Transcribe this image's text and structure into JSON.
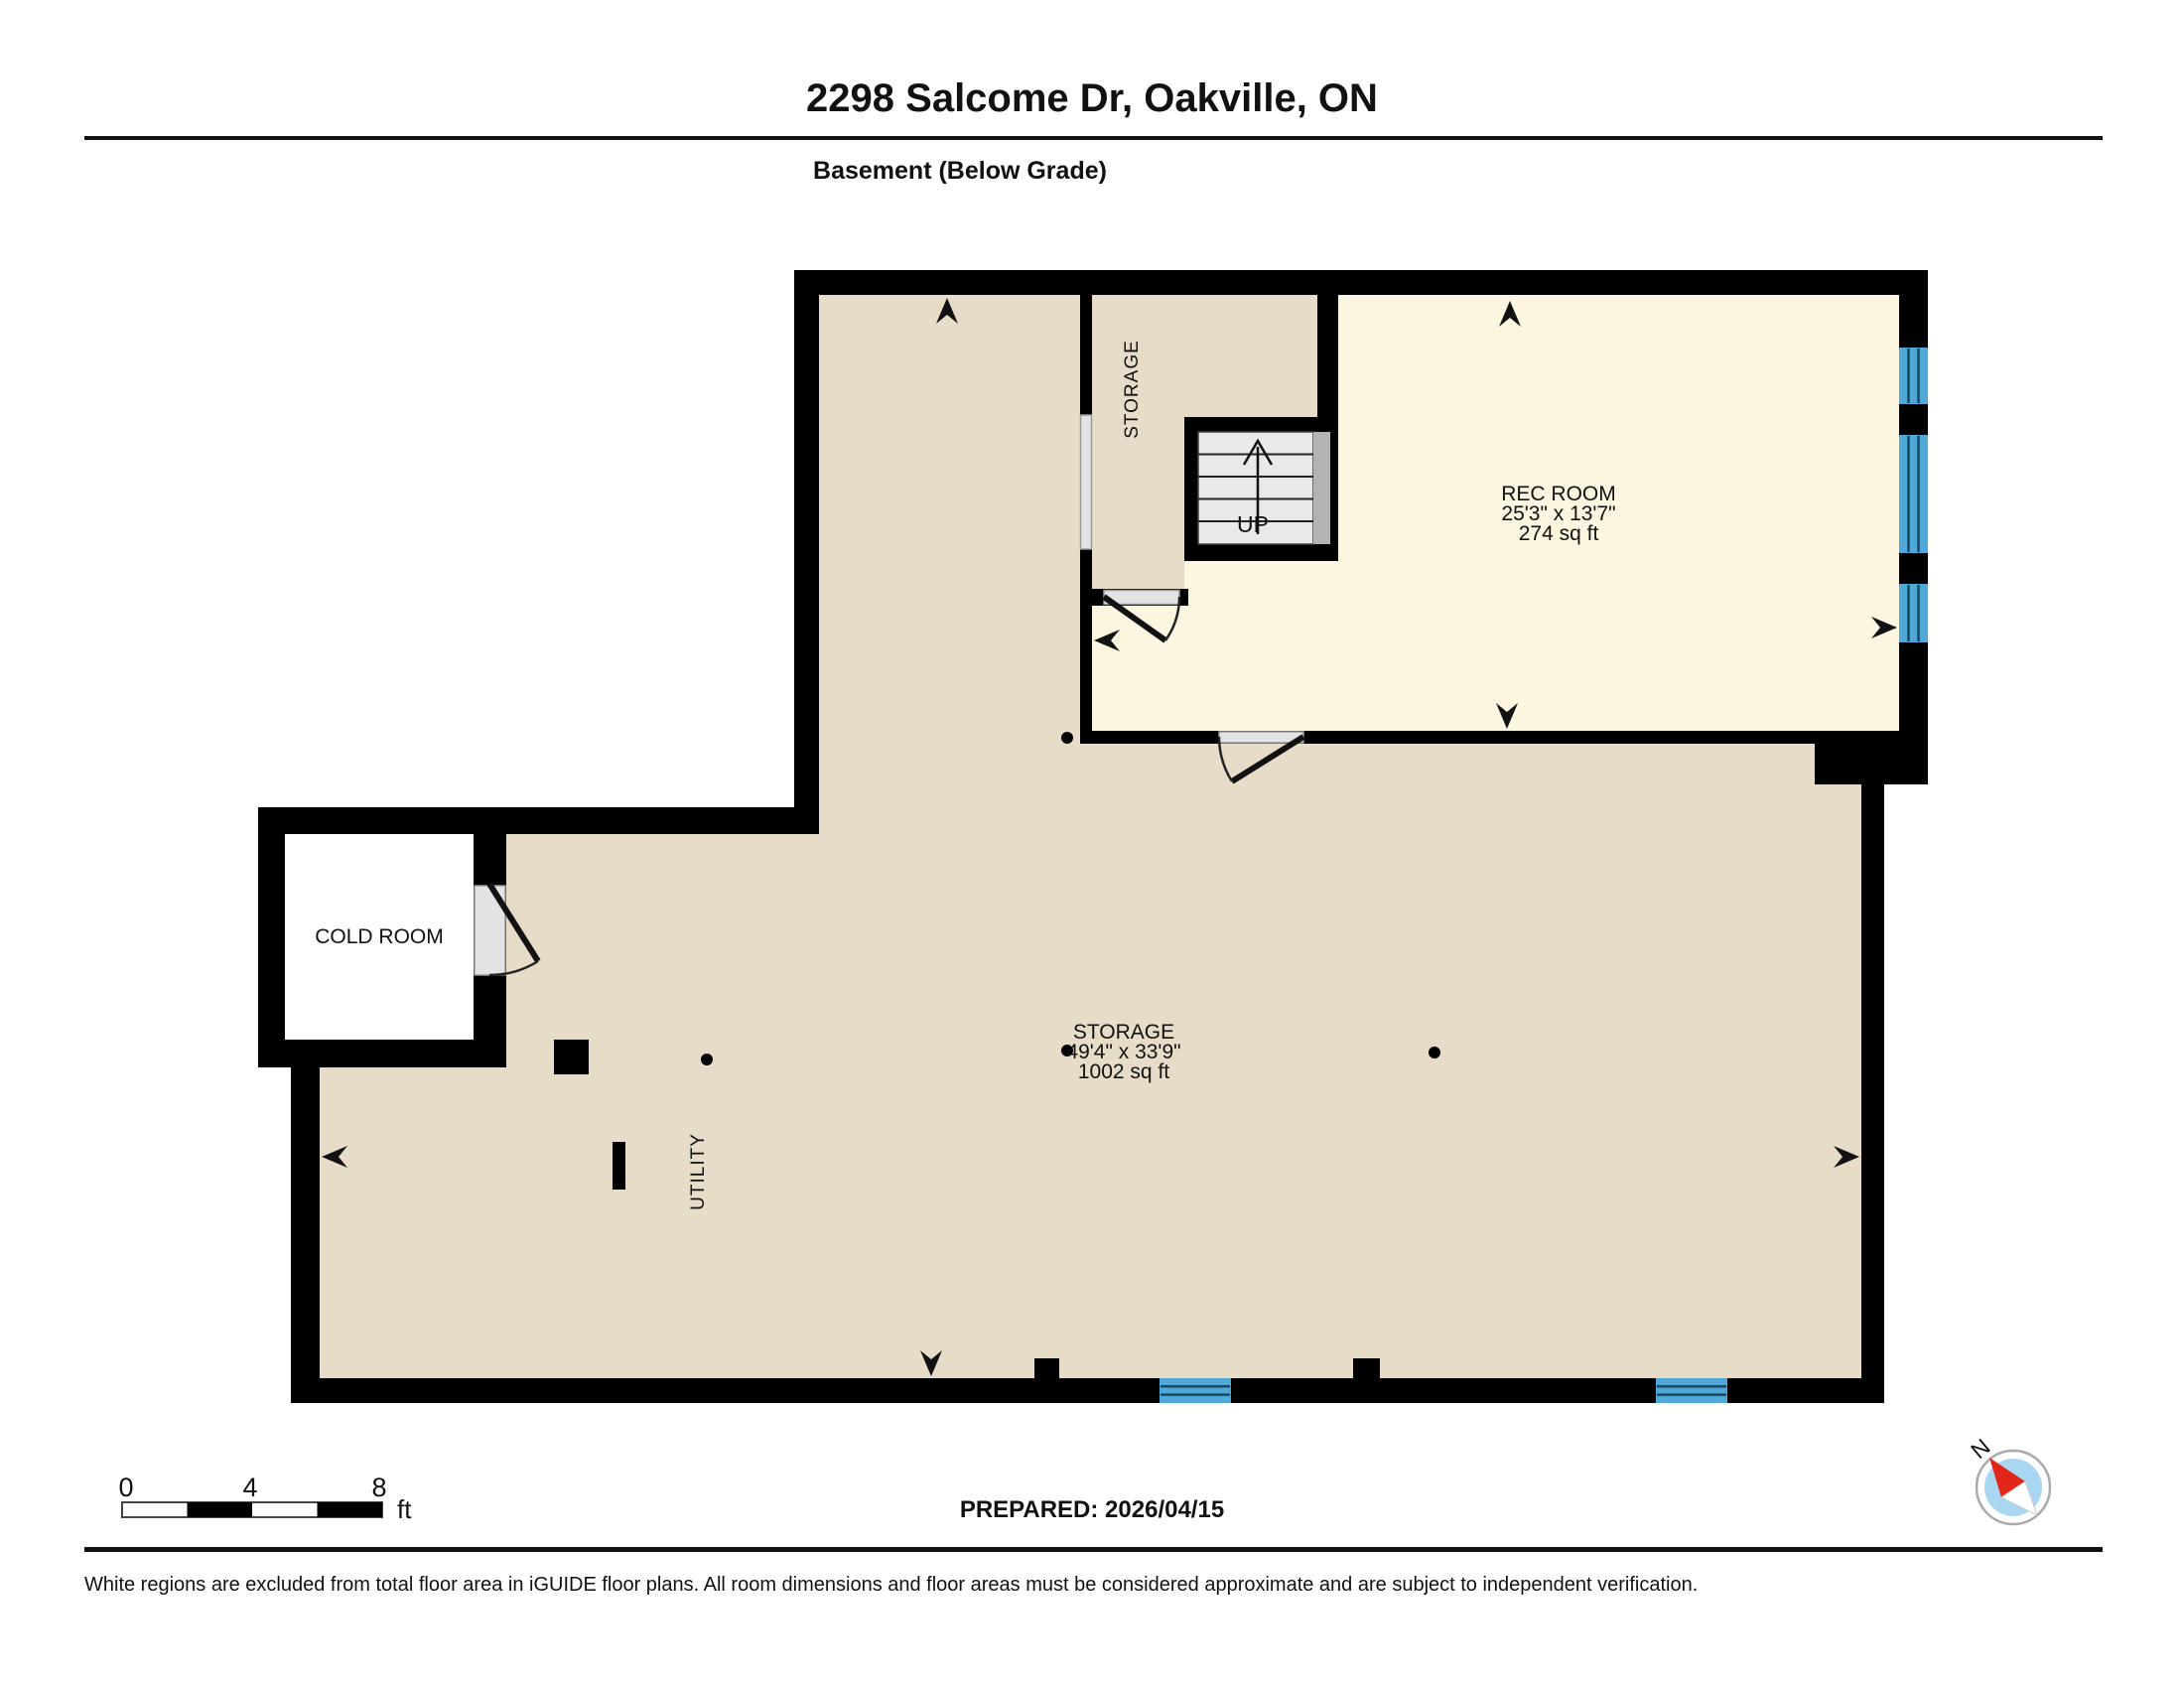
{
  "header": {
    "title": "2298 Salcome Dr, Oakville, ON",
    "subtitle": "Basement (Below Grade)"
  },
  "rooms": {
    "rec_room": {
      "name": "REC ROOM",
      "dims": "25'3\" x 13'7\"",
      "area": "274 sq ft"
    },
    "storage_main": {
      "name": "STORAGE",
      "dims": "49'4\" x 33'9\"",
      "area": "1002 sq ft"
    },
    "storage_upper": {
      "name": "STORAGE"
    },
    "cold_room": {
      "name": "COLD ROOM"
    },
    "utility": {
      "name": "UTILITY"
    },
    "stairs_label": "UP"
  },
  "scale_bar": {
    "t0": "0",
    "t4": "4",
    "t8": "8",
    "unit": "ft"
  },
  "prepared_label": "PREPARED: 2026/04/15",
  "compass": {
    "north": "N"
  },
  "footer": {
    "disclaimer": "White regions are excluded from total floor area in iGUIDE floor plans. All room dimensions and floor areas must be considered approximate and are subject to independent verification."
  },
  "colors": {
    "floor_tan": "#E6DCC8",
    "floor_cream": "#FCF5DF",
    "wall_black": "#000000",
    "window_blue": "#4FA8D8",
    "door_gray": "#E3E3E3",
    "stair_gray": "#E9E9E9",
    "landing_gray": "#B3B3B3",
    "compass_blue": "#A9D7F2",
    "compass_red": "#E3261A"
  }
}
